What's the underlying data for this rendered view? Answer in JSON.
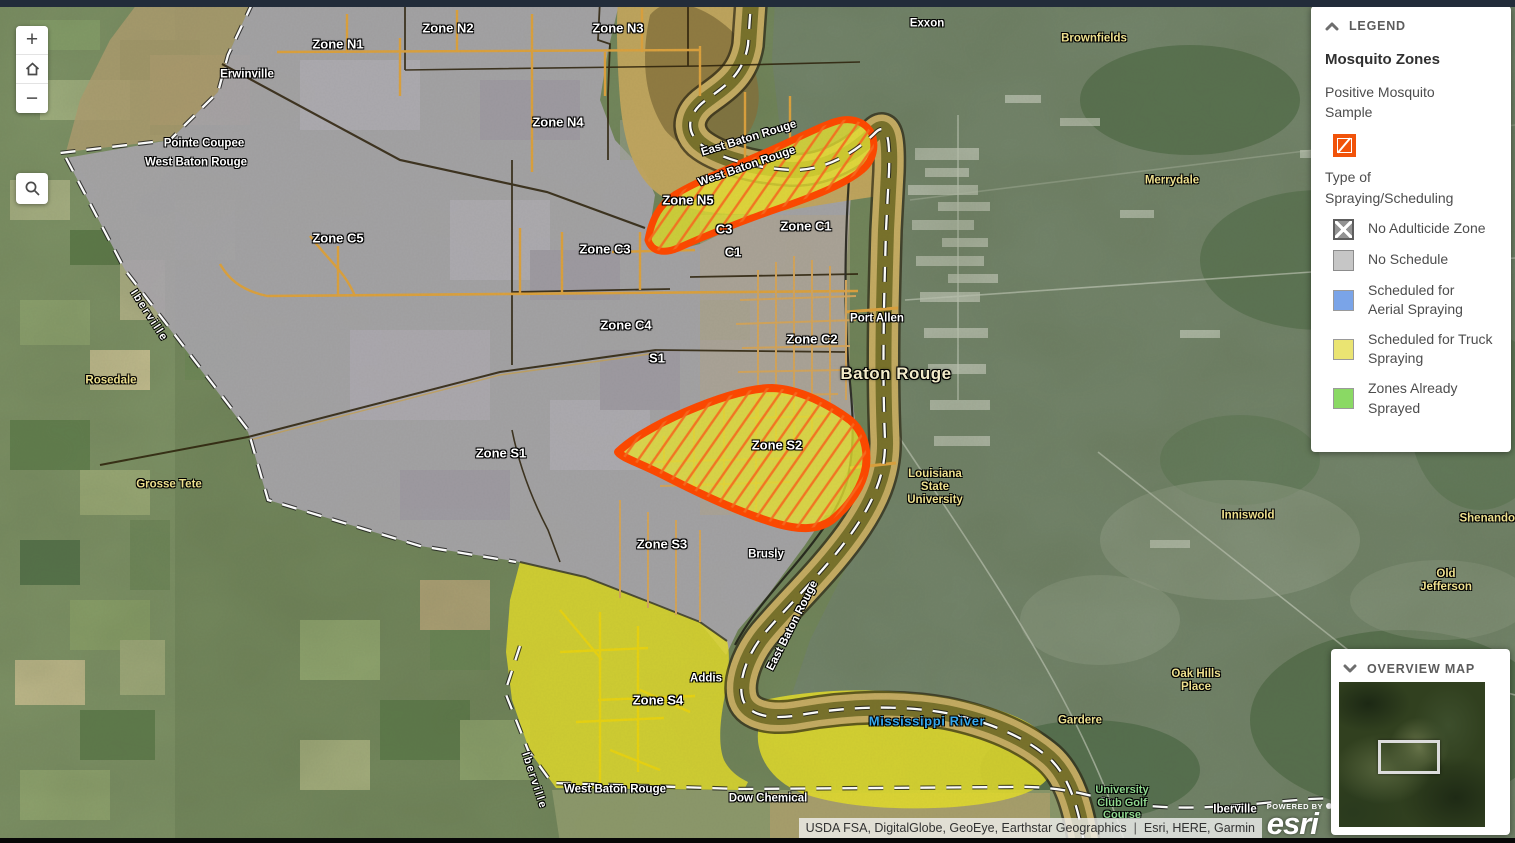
{
  "controls": {
    "zoom_in_label": "+",
    "zoom_out_label": "−",
    "home_icon": "home-icon",
    "search_icon": "magnifier-icon"
  },
  "legend": {
    "title": "LEGEND",
    "layer_title": "Mosquito Zones",
    "sample_label": "Positive Mosquito Sample",
    "sample_color": "#f1530a",
    "section_title": "Type of Spraying/Scheduling",
    "items": [
      {
        "label": "No Adulticide Zone",
        "swatch": "crosshatch",
        "fill": "#939393",
        "border": "#5e5e5e"
      },
      {
        "label": "No Schedule",
        "swatch": "solid",
        "fill": "#c6c6c6",
        "border": "#8c8c8c"
      },
      {
        "label": "Scheduled for Aerial Spraying",
        "swatch": "solid",
        "fill": "#7aa4e8",
        "border": "#9a9a9a"
      },
      {
        "label": "Scheduled for Truck Spraying",
        "swatch": "solid",
        "fill": "#eae472",
        "border": "#9a9a9a"
      },
      {
        "label": "Zones Already Sprayed",
        "swatch": "solid",
        "fill": "#8ad964",
        "border": "#9a9a9a"
      }
    ]
  },
  "overview": {
    "title": "OVERVIEW MAP"
  },
  "attribution": {
    "sources": "USDA FSA, DigitalGlobe, GeoEye, Earthstar Geographics",
    "separator": "|",
    "vendors": "Esri, HERE, Garmin",
    "powered_by": "POWERED BY",
    "logo_text": "esri"
  },
  "map": {
    "highlight_colors": {
      "zone_fill": "#e8e332",
      "sample_outline": "#ff4800",
      "hatch": "#f96b1f"
    },
    "labels": [
      {
        "text": "Zone N1",
        "x": 338,
        "y": 45,
        "type": "zone"
      },
      {
        "text": "Zone N2",
        "x": 448,
        "y": 29,
        "type": "zone"
      },
      {
        "text": "Zone N3",
        "x": 618,
        "y": 29,
        "type": "zone"
      },
      {
        "text": "Zone N4",
        "x": 558,
        "y": 123,
        "type": "zone"
      },
      {
        "text": "Zone N5",
        "x": 688,
        "y": 201,
        "type": "zone"
      },
      {
        "text": "Zone C1",
        "x": 806,
        "y": 227,
        "type": "zone"
      },
      {
        "text": "C3",
        "x": 724,
        "y": 230,
        "type": "zone"
      },
      {
        "text": "C1",
        "x": 733,
        "y": 253,
        "type": "zone"
      },
      {
        "text": "Zone C3",
        "x": 605,
        "y": 250,
        "type": "zone"
      },
      {
        "text": "Zone C5",
        "x": 338,
        "y": 239,
        "type": "zone"
      },
      {
        "text": "Zone C4",
        "x": 626,
        "y": 326,
        "type": "zone"
      },
      {
        "text": "Zone C2",
        "x": 812,
        "y": 340,
        "type": "zone"
      },
      {
        "text": "S1",
        "x": 657,
        "y": 359,
        "type": "zone"
      },
      {
        "text": "Zone S1",
        "x": 501,
        "y": 454,
        "type": "zone"
      },
      {
        "text": "Zone S2",
        "x": 777,
        "y": 446,
        "type": "zone"
      },
      {
        "text": "Zone S3",
        "x": 662,
        "y": 545,
        "type": "zone"
      },
      {
        "text": "Zone S4",
        "x": 658,
        "y": 701,
        "type": "zone"
      },
      {
        "text": "Erwinville",
        "x": 247,
        "y": 75,
        "type": "place"
      },
      {
        "text": "Pointe Coupee",
        "x": 204,
        "y": 144,
        "type": "place"
      },
      {
        "text": "West Baton Rouge",
        "x": 196,
        "y": 163,
        "type": "place"
      },
      {
        "text": "Port Allen",
        "x": 877,
        "y": 319,
        "type": "place"
      },
      {
        "text": "Brusly",
        "x": 766,
        "y": 555,
        "type": "place"
      },
      {
        "text": "Addis",
        "x": 706,
        "y": 679,
        "type": "place"
      },
      {
        "text": "Dow Chemical",
        "x": 768,
        "y": 799,
        "type": "place"
      },
      {
        "text": "West Baton Rouge",
        "x": 615,
        "y": 790,
        "type": "place"
      },
      {
        "text": "Exxon",
        "x": 927,
        "y": 24,
        "type": "place"
      },
      {
        "text": "Iberville",
        "x": 1235,
        "y": 810,
        "type": "place"
      },
      {
        "text": "Baton Rouge",
        "x": 896,
        "y": 374,
        "type": "big"
      },
      {
        "text": "Rosedale",
        "x": 111,
        "y": 381,
        "type": "area"
      },
      {
        "text": "Grosse Tete",
        "x": 169,
        "y": 485,
        "type": "area"
      },
      {
        "text": "Brownfields",
        "x": 1094,
        "y": 39,
        "type": "area"
      },
      {
        "text": "Merrydale",
        "x": 1172,
        "y": 181,
        "type": "area"
      },
      {
        "text": "Inniswold",
        "x": 1248,
        "y": 516,
        "type": "area"
      },
      {
        "text": "Shenandoah",
        "x": 1494,
        "y": 519,
        "type": "area"
      },
      {
        "text": "Old Jefferson",
        "x": 1446,
        "y": 581,
        "type": "area"
      },
      {
        "text": "Oak Hills\nPlace",
        "x": 1196,
        "y": 681,
        "type": "area"
      },
      {
        "text": "Gardere",
        "x": 1080,
        "y": 721,
        "type": "area"
      },
      {
        "text": "Louisiana\nState\nUniversity",
        "x": 935,
        "y": 488,
        "type": "area"
      },
      {
        "text": "University\nClub Golf\nCourse",
        "x": 1122,
        "y": 803,
        "type": "golf"
      },
      {
        "text": "Mississippi River",
        "x": 927,
        "y": 722,
        "type": "water"
      },
      {
        "text": "Iberville",
        "x": 149,
        "y": 316,
        "type": "parish",
        "rot": 57
      },
      {
        "text": "Iberville",
        "x": 534,
        "y": 781,
        "type": "parish",
        "rot": 72
      },
      {
        "text": "East Baton Rouge",
        "x": 749,
        "y": 139,
        "type": "place",
        "rot": -17
      },
      {
        "text": "West Baton Rouge",
        "x": 747,
        "y": 167,
        "type": "place",
        "rot": -19
      },
      {
        "text": "East Baton Rouge",
        "x": 793,
        "y": 626,
        "type": "place",
        "rot": -63
      }
    ]
  }
}
